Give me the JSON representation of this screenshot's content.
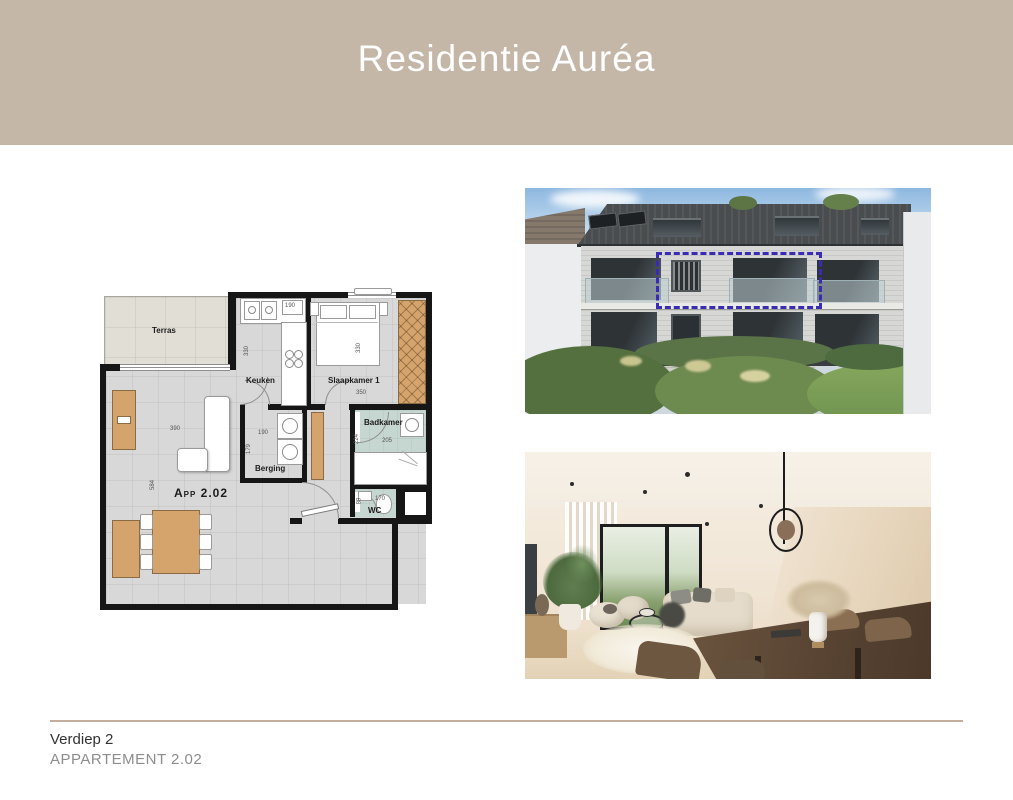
{
  "header": {
    "title": "Residentie Auréa"
  },
  "footer": {
    "floor": "Verdiep 2",
    "apartment": "APPARTEMENT 2.02"
  },
  "floorplan": {
    "apartment_label": "App 2.02",
    "rooms": {
      "terras": "Terras",
      "keuken": "Keuken",
      "slaapkamer": "Slaapkamer 1",
      "badkamer": "Badkamer",
      "berging": "Berging",
      "wc": "WC"
    },
    "dims": {
      "keuken_w": "190",
      "keuken_d": "330",
      "slaapkamer_d": "330",
      "slaapkamer_w": "350",
      "living_w": "390",
      "living_d": "584",
      "berging_w": "190",
      "berging_d": "179",
      "badkamer_d": "224",
      "badkamer_w": "205",
      "wc_w": "170",
      "wc_d": "89"
    }
  },
  "colors": {
    "header_band": "#c5b7a8",
    "divider_rule": "#c3ae9d",
    "highlight_box": "#3a2bb5",
    "bathroom_floor": "#c6d6d0",
    "wood_furniture": "#d4a46c"
  }
}
